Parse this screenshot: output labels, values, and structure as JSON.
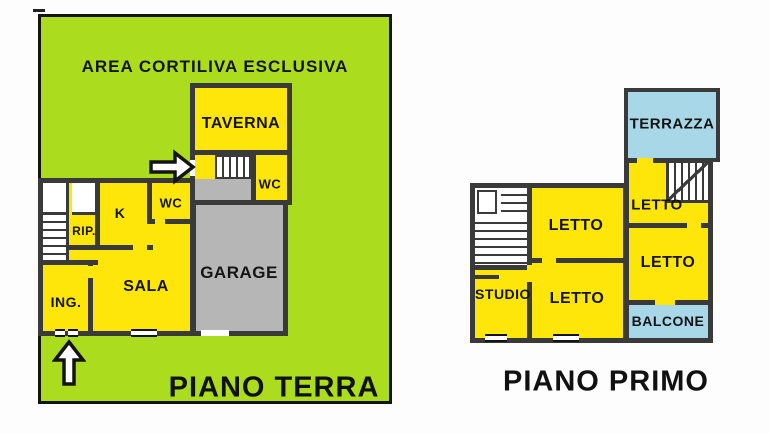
{
  "colors": {
    "courtyard_green": "#abdd1e",
    "room_yellow": "#ffe60a",
    "garage_gray": "#b6b6b6",
    "terrace_blue": "#a8d8e8",
    "wall_dark": "#3a3a3a"
  },
  "icons": {
    "side_entrance": "arrow-right",
    "front_entrance": "arrow-up"
  },
  "ground_floor": {
    "title": "PIANO TERRA",
    "courtyard_label": "AREA CORTILIVA ESCLUSIVA",
    "rooms": {
      "taverna": "TAVERNA",
      "wc_taverna": "WC",
      "wc_main": "WC",
      "kitchen": "K",
      "rip": "RIP.",
      "sala": "SALA",
      "ing": "ING.",
      "garage": "GARAGE"
    }
  },
  "first_floor": {
    "title": "PIANO PRIMO",
    "rooms": {
      "terrazza": "TERRAZZA",
      "letto_top_right": "LETTO",
      "letto_right": "LETTO",
      "letto_top": "LETTO",
      "letto_bottom": "LETTO",
      "studio": "STUDIO",
      "balcone": "BALCONE"
    }
  }
}
